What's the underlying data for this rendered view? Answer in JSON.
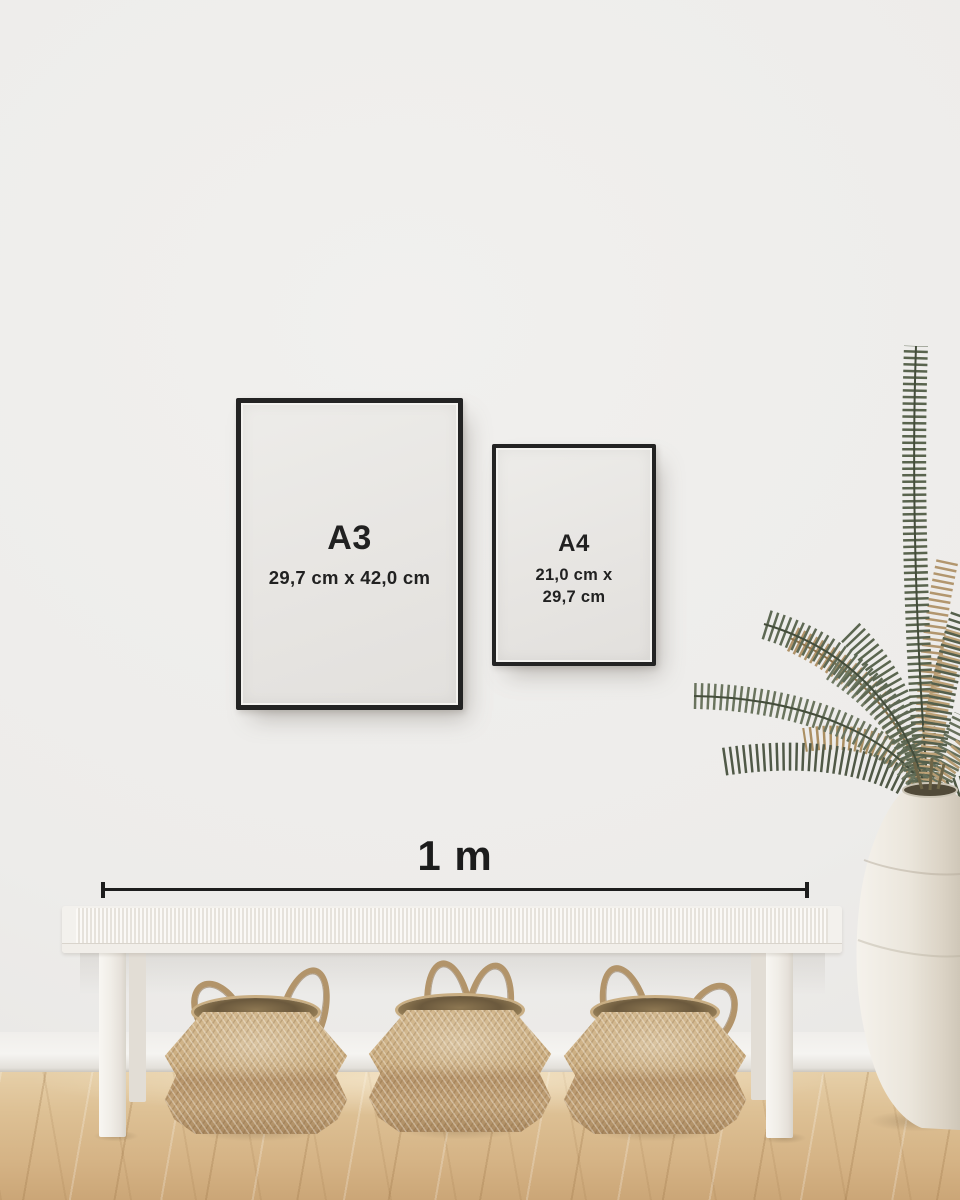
{
  "frames": [
    {
      "label": "A3",
      "dimensions": "29,7 cm x 42,0 cm"
    },
    {
      "label": "A4",
      "dimensions_line1": "21,0 cm x",
      "dimensions_line2": "29,7 cm"
    }
  ],
  "scale": {
    "label": "1 m"
  },
  "colors": {
    "frame_black": "#232323",
    "annotation_text": "#1d1d1d",
    "paper_white": "#e9e7e4",
    "wall_gray": "#eeedeb",
    "floor_wood": "#dcbd90",
    "basket_tan": "#c6aa7e",
    "bench_white": "#f2efe9",
    "plant_green": "#5d6852",
    "plant_tan": "#ae9165",
    "vase_cream": "#ece7dd"
  }
}
